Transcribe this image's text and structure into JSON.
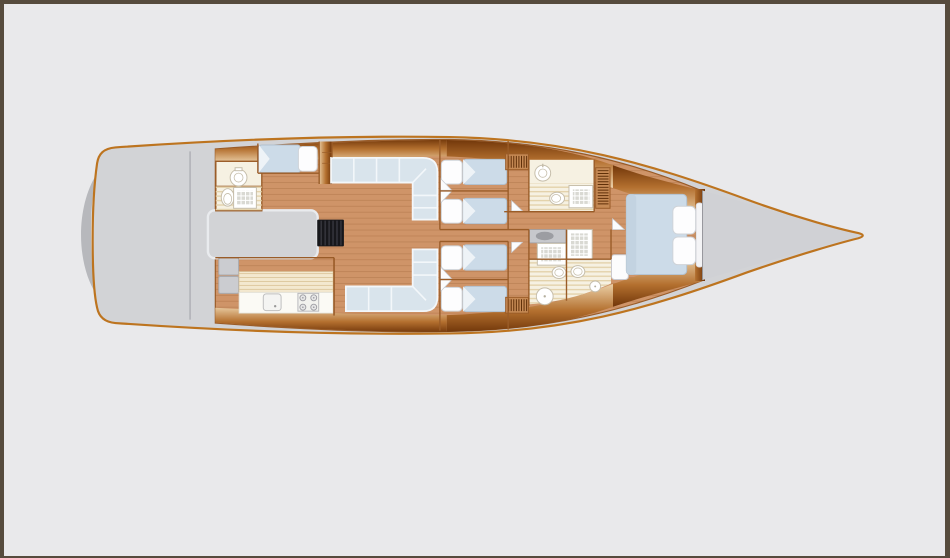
{
  "title": "sailing-yacht-interior-deck-plan",
  "canvas": {
    "width": 950,
    "height": 558
  },
  "palette": {
    "page_bg": "#e9e9eb",
    "frame": "#564b3d",
    "hull_outline": "#bd741f",
    "deck": "#d2d3d6",
    "deck_seam": "#b5b6bb",
    "deck_shadow": "#b7b8bc",
    "corridor_trim": "#e9ebee",
    "wood": "#cf9468",
    "plank": "#8a5226",
    "wall": "#9a5c28",
    "band_dark": "#6e3408",
    "band_mid": "#b4702f",
    "band_light": "#ecd2aa",
    "cushion": "#d9e4ec",
    "cushion_line": "#f3f7fa",
    "mattress": "#ccdbe8",
    "mattress_edge": "#b2c1cf",
    "pillow": "#fdfdfe",
    "pillow_edge": "#cfd3d8",
    "bath_floor": "#f6f1e2",
    "bath_stripe": "#e3d2ab",
    "fixture": "#ffffff",
    "fixture_edge": "#c6beab",
    "shower_bg": "#d9d9d3",
    "steps_bg": "#17171b",
    "steps_stripe": "#3d3d45",
    "counter_bg": "#f3e8cf",
    "counter_stripe": "#dec9a0",
    "counter_white": "#fbfaf5",
    "cabinet_gray": "#cbccd0",
    "cabinet_edge": "#a9aaae",
    "vanity": "#c7c8cc",
    "vanity_sink": "#9c9da2",
    "slat_bg": "#c68a55",
    "slat_line": "#5f2f08",
    "bow_deck": "#d0d1d5",
    "appliance_edge": "#b9b9bd"
  },
  "scene": {
    "type": "yacht-interior-floor-plan",
    "orientation": {
      "bow": "right",
      "stern": "left",
      "port": "top",
      "starboard": "bottom"
    },
    "rooms": [
      {
        "id": "cockpit",
        "label": "cockpit"
      },
      {
        "id": "companionway",
        "label": "companionway"
      },
      {
        "id": "aft-head",
        "label": "aft-head"
      },
      {
        "id": "aft-cabin-port",
        "label": "aft-cabin-port"
      },
      {
        "id": "galley",
        "label": "galley"
      },
      {
        "id": "saloon",
        "label": "saloon"
      },
      {
        "id": "guest-cabin-port-1",
        "label": "guest-cabin-port-1"
      },
      {
        "id": "guest-cabin-port-2",
        "label": "guest-cabin-port-2"
      },
      {
        "id": "guest-cabin-starboard-1",
        "label": "guest-cabin-starboard-1"
      },
      {
        "id": "guest-cabin-starboard-2",
        "label": "guest-cabin-starboard-2"
      },
      {
        "id": "bathroom-port-forward",
        "label": "bathroom-port-forward"
      },
      {
        "id": "bathroom-starboard-forward",
        "label": "bathroom-starboard-forward"
      },
      {
        "id": "owner-cabin",
        "label": "owner-cabin"
      },
      {
        "id": "foredeck",
        "label": "foredeck"
      }
    ],
    "fixture_counts": {
      "single_beds": 4,
      "double_beds": 2,
      "sofas": 2,
      "sinks": 6,
      "toilets": 5,
      "showers": 5,
      "stove_burners": 4
    }
  }
}
